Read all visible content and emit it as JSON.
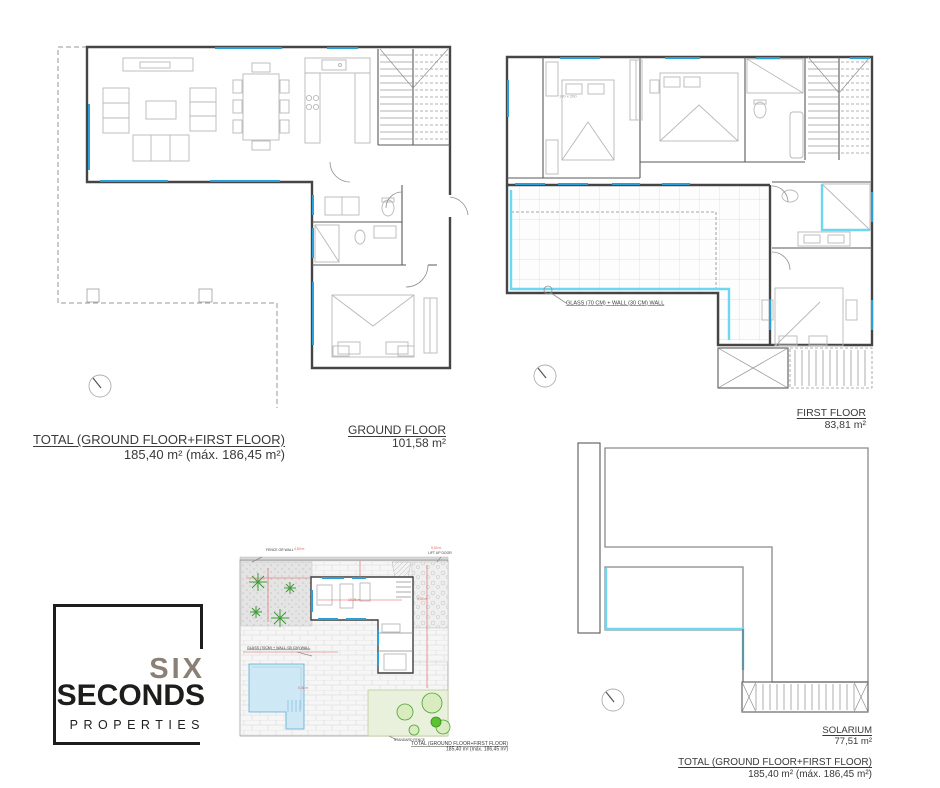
{
  "plans": {
    "ground_floor": {
      "label": "GROUND FLOOR",
      "area": "101,58 m²"
    },
    "first_floor": {
      "label": "FIRST FLOOR",
      "area": "83,81 m²"
    },
    "solarium": {
      "label": "SOLARIUM",
      "area": "77,51 m²"
    }
  },
  "totals": {
    "left": {
      "title": "TOTAL (GROUND FLOOR+FIRST FLOOR)",
      "value": "185,40 m² (máx. 186,45 m²)"
    },
    "right": {
      "title": "TOTAL (GROUND FLOOR+FIRST FLOOR)",
      "value": "185,40 m² (máx. 186,45 m²)"
    },
    "site": {
      "title": "TOTAL (GROUND FLOOR+FIRST FLOOR)",
      "value": "185,40 m² (máx. 186,45 m²)"
    }
  },
  "annotations": {
    "glass_wall_first_floor": "GLASS (70 CM) + WALL (30 CM) WALL",
    "glass_wall_site": "GLASS (70CM) + WALL (30 CM) WALL",
    "fence_top": "FENCE OR WALL",
    "lift_up_door": "LIFT UP DOOR",
    "standard_fence": "STANDARD FENCE",
    "bed_size": "180 x 200"
  },
  "site_dimensions": {
    "d1": "4,50 m",
    "d2": "5,00 m",
    "d3": "3,00 m",
    "d4": "10,05 m",
    "d5": "0,40 m"
  },
  "logo": {
    "word1": "SIX",
    "word2": "SECONDS",
    "word3": "PROPERTIES"
  },
  "colors": {
    "wall": "#454545",
    "window_blue": "#2b9fd8",
    "glass_cyan": "#6fd6f0",
    "dimension_red": "#d95f5f",
    "pool_fill": "#cfe8f5",
    "lawn_fill": "#e9f0dc",
    "tree_green": "#4aa32f",
    "logo_taupe": "#8a8076",
    "logo_black": "#1d1d1b"
  }
}
